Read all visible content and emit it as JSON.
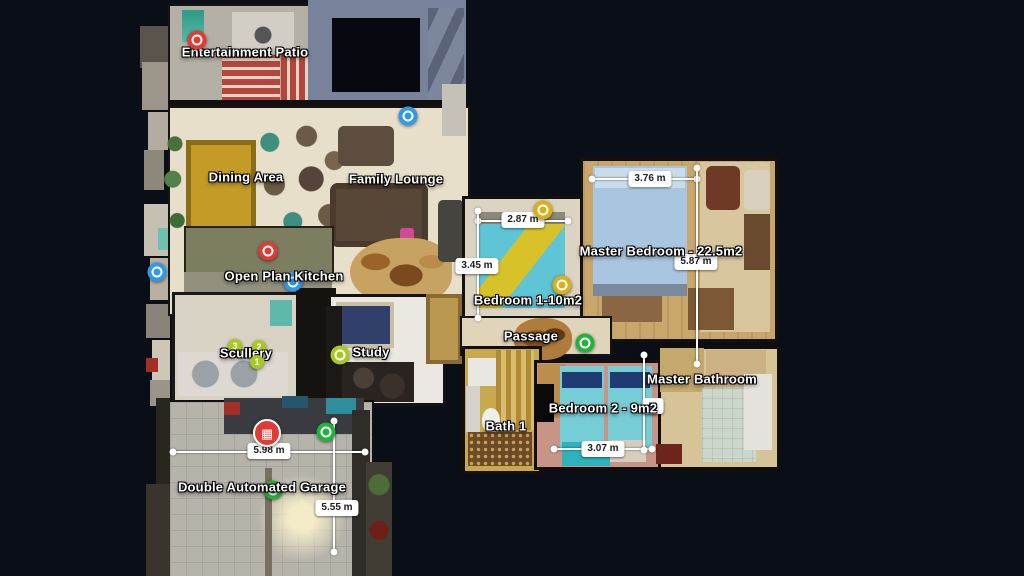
{
  "scene": {
    "title": "3D Floor Plan (top-down dollhouse view)",
    "background_color": "#0a0e17"
  },
  "marker_colors": {
    "red": "#e23b35",
    "blue": "#2f9be8",
    "yellow": "#d9af1c",
    "lime": "#a9c71f",
    "green": "#23b23c"
  },
  "rooms": [
    {
      "id": "entertainment-patio",
      "label": "Entertainment Patio",
      "x": 245,
      "y": 53
    },
    {
      "id": "dining-area",
      "label": "Dining Area",
      "x": 246,
      "y": 178
    },
    {
      "id": "family-lounge",
      "label": "Family Lounge",
      "x": 396,
      "y": 180
    },
    {
      "id": "open-plan-kitchen",
      "label": "Open Plan Kitchen",
      "x": 284,
      "y": 277
    },
    {
      "id": "scullery",
      "label": "Scullery",
      "x": 246,
      "y": 354
    },
    {
      "id": "study",
      "label": "Study",
      "x": 371,
      "y": 353
    },
    {
      "id": "bedroom-1",
      "label": "Bedroom 1-10m2",
      "x": 528,
      "y": 301
    },
    {
      "id": "passage",
      "label": "Passage",
      "x": 531,
      "y": 337
    },
    {
      "id": "master-bedroom",
      "label": "Master Bedroom - 22.5m2",
      "x": 661,
      "y": 252
    },
    {
      "id": "master-bathroom",
      "label": "Master Bathroom",
      "x": 702,
      "y": 380
    },
    {
      "id": "bedroom-2",
      "label": "Bedroom 2 - 9m2",
      "x": 603,
      "y": 409
    },
    {
      "id": "bath-1",
      "label": "Bath 1",
      "x": 506,
      "y": 427
    },
    {
      "id": "double-automated-garage",
      "label": "Double Automated Garage",
      "x": 262,
      "y": 488
    }
  ],
  "markers": [
    {
      "id": "tag-entertainment-patio",
      "kind": "donut",
      "color": "red",
      "x": 197,
      "y": 40
    },
    {
      "id": "tag-family-lounge",
      "kind": "donut",
      "color": "blue",
      "x": 408,
      "y": 116
    },
    {
      "id": "tag-left-edge",
      "kind": "donut",
      "color": "blue",
      "x": 157,
      "y": 272
    },
    {
      "id": "tag-open-plan-kitchen",
      "kind": "donut",
      "color": "red",
      "x": 268,
      "y": 251
    },
    {
      "id": "tag-kitchen-hidden",
      "kind": "donut",
      "color": "blue",
      "x": 293,
      "y": 282,
      "behind_label": true
    },
    {
      "id": "tag-scullery-3",
      "kind": "badge",
      "color": "lime",
      "number": "3",
      "x": 235,
      "y": 346,
      "behind_label": true
    },
    {
      "id": "tag-scullery-2",
      "kind": "badge",
      "color": "lime",
      "number": "2",
      "x": 259,
      "y": 347,
      "behind_label": true
    },
    {
      "id": "tag-scullery-1",
      "kind": "badge",
      "color": "lime",
      "number": "1",
      "x": 257,
      "y": 362
    },
    {
      "id": "tag-study",
      "kind": "donut",
      "color": "lime",
      "x": 340,
      "y": 355
    },
    {
      "id": "tag-bedroom1-top",
      "kind": "donut",
      "color": "yellow",
      "x": 543,
      "y": 210
    },
    {
      "id": "tag-bedroom1",
      "kind": "donut",
      "color": "yellow",
      "x": 562,
      "y": 285
    },
    {
      "id": "tag-passage",
      "kind": "donut",
      "color": "green",
      "x": 585,
      "y": 343
    },
    {
      "id": "tag-garage-view",
      "kind": "grid",
      "color": "red",
      "glyph": "▦",
      "x": 267,
      "y": 433
    },
    {
      "id": "tag-garage",
      "kind": "donut",
      "color": "green",
      "x": 326,
      "y": 432
    },
    {
      "id": "tag-garage-hidden",
      "kind": "donut",
      "color": "green",
      "x": 273,
      "y": 490,
      "behind_label": true
    }
  ],
  "measurements": [
    {
      "id": "bedroom1-width",
      "text": "2.87 m",
      "x1": 478,
      "y1": 221,
      "x2": 568,
      "y2": 221,
      "lx": 523,
      "ly": 220
    },
    {
      "id": "bedroom1-depth",
      "text": "3.45 m",
      "x1": 478,
      "y1": 211,
      "x2": 478,
      "y2": 318,
      "lx": 477,
      "ly": 266
    },
    {
      "id": "master-width",
      "text": "3.76 m",
      "x1": 592,
      "y1": 179,
      "x2": 697,
      "y2": 179,
      "lx": 650,
      "ly": 179
    },
    {
      "id": "master-depth",
      "text": "5.87 m",
      "x1": 697,
      "y1": 168,
      "x2": 697,
      "y2": 364,
      "lx": 696,
      "ly": 262
    },
    {
      "id": "garage-width",
      "text": "5.98 m",
      "x1": 173,
      "y1": 452,
      "x2": 365,
      "y2": 452,
      "lx": 269,
      "ly": 451
    },
    {
      "id": "garage-depth",
      "text": "5.55 m",
      "x1": 334,
      "y1": 421,
      "x2": 334,
      "y2": 552,
      "lx": 337,
      "ly": 508
    },
    {
      "id": "bedroom2-width",
      "text": "3.07 m",
      "x1": 554,
      "y1": 449,
      "x2": 652,
      "y2": 449,
      "lx": 603,
      "ly": 449
    },
    {
      "id": "bedroom2-depth",
      "text": "m",
      "x1": 644,
      "y1": 355,
      "x2": 644,
      "y2": 450,
      "lx": 653,
      "ly": 406,
      "behind_label": true
    }
  ]
}
